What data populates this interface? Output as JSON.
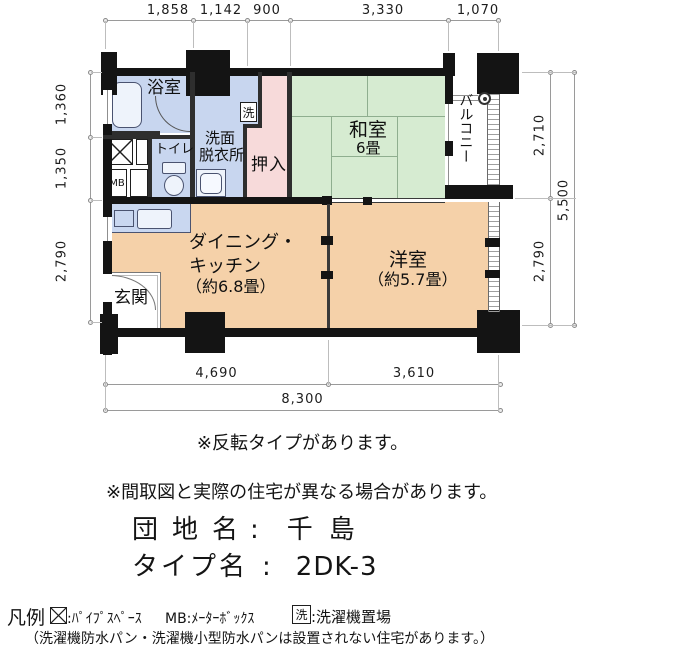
{
  "plan": {
    "rooms": {
      "bath": "浴室",
      "washroom_line1": "洗面",
      "washroom_line2": "脱衣所",
      "laundry_mark": "洗",
      "toilet": "トイレ",
      "meter_box": "MB",
      "closet": "押入",
      "tatami_room": "和室",
      "tatami_room_size": "6畳",
      "balcony": "バルコニー",
      "dining_line1": "ダイニング・",
      "dining_line2": "キッチン",
      "dining_size": "（約6.8畳）",
      "western_room": "洋室",
      "western_room_size": "（約5.7畳）",
      "entrance": "玄関"
    },
    "dims": {
      "top": [
        "1,858",
        "1,142",
        "900",
        "3,330",
        "1,070"
      ],
      "left": [
        "1,360",
        "1,350",
        "2,790"
      ],
      "right": [
        "2,710",
        "2,790"
      ],
      "right_total": "5,500",
      "bottom": [
        "4,690",
        "3,610"
      ],
      "bottom_total": "8,300"
    }
  },
  "notes": {
    "flip": "※反転タイプがあります。",
    "difference": "※間取図と実際の住宅が異なる場合があります。"
  },
  "property": {
    "estate_label": "団地名",
    "estate_colon": ":",
    "estate_value": "千島",
    "type_label": "タイプ名",
    "type_colon": ":",
    "type_value": "2DK-3"
  },
  "legend": {
    "title": "凡例",
    "pipe_space": ":ﾊﾟｲﾌﾟｽﾍﾟｰｽ",
    "meter_box": "MB:ﾒｰﾀｰﾎﾞｯｸｽ",
    "laundry_mark": "洗",
    "laundry_place": ":洗濯機置場",
    "note": "（洗濯機防水パン・洗濯機小型防水パンは設置されない住宅があります。）"
  },
  "colors": {
    "wet_area": "#c8d6ef",
    "kitchen_counter": "#c9d7f0",
    "tatami_room": "#d6ebd1",
    "closet": "#f7dada",
    "living_rooms": "#f5d1a9",
    "wall": "#141414",
    "tatami_line": "#8fae8f",
    "dimension_line": "#9a9a9a"
  }
}
